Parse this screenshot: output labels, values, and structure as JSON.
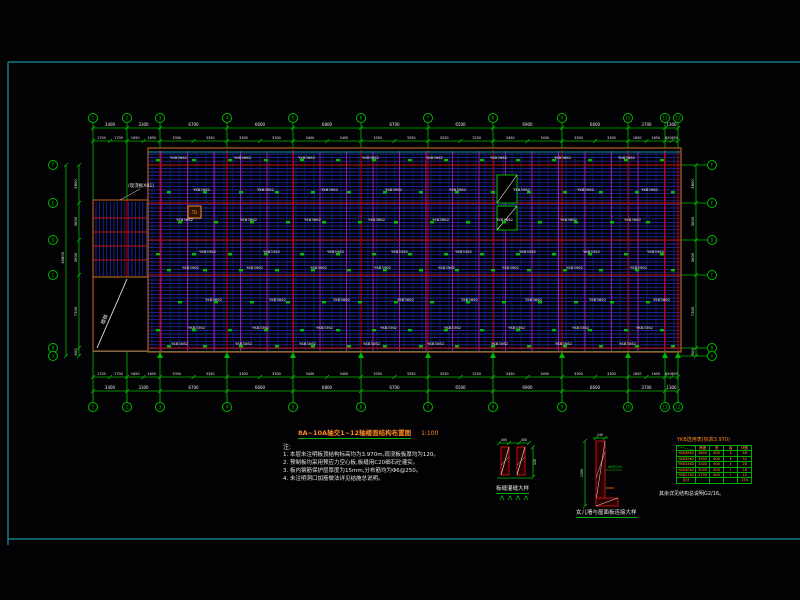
{
  "drawing": {
    "title": "8A~10A轴交1~12轴楼面结构布置图",
    "scale": "1:100",
    "notes_label": "注:",
    "notes": [
      "1. 本层未注明板顶结构标高均为3.970m,现浇板板厚均为120。",
      "2. 预制板均采用预应力空心板,板缝用C20细石砼灌实。",
      "3. 板内钢筋保护层厚度为15mm,分布筋均为Φ6@250。",
      "4. 未注明洞口加筋做法详见结施总说明。"
    ],
    "cast_label": "(现浇板XB1)",
    "stair_label": "楼梯",
    "opening_label": "TD"
  },
  "axes": {
    "top": [
      "1",
      "2",
      "3",
      "4",
      "5",
      "6",
      "7",
      "8",
      "9",
      "10",
      "11",
      "12"
    ],
    "left": [
      "F",
      "E",
      "D",
      "C",
      "B",
      "A"
    ],
    "right": [
      "F",
      "E",
      "D",
      "C",
      "B",
      "A"
    ]
  },
  "dimensions": {
    "top_spans": [
      "3400",
      "3300",
      "6700",
      "6600",
      "6800",
      "6700",
      "6500",
      "6900",
      "6600",
      "3700",
      "1300"
    ],
    "left_spans": [
      "3800",
      "3600",
      "3600",
      "7300",
      "800"
    ],
    "left_total": "18800"
  },
  "plank_rows": [
    "YKB3662",
    "YKB3962",
    "YKB3662",
    "YKB3362",
    "YKB3962",
    "YKB3662",
    "YKB3362",
    "YKB3062"
  ],
  "details": {
    "left": {
      "label": "板缝灌缝大样",
      "dim_a": "400",
      "dim_b": "400",
      "dim_h": "120"
    },
    "right": {
      "label": "女儿墙与屋面板连接大样",
      "dim_h": "1200",
      "dim_w": "240",
      "rebar": "Φ8@200"
    }
  },
  "table": {
    "title": "YKB选用表(标高3.970)",
    "headers": [
      "板号",
      "跨度",
      "宽",
      "级",
      "块数"
    ],
    "rows": [
      [
        "YKB3662",
        "3600",
        "600",
        "Ⅱ",
        "46"
      ],
      [
        "YKB3962",
        "3900",
        "600",
        "Ⅱ",
        "52"
      ],
      [
        "YKB3362",
        "3300",
        "600",
        "Ⅱ",
        "28"
      ],
      [
        "YKB3062",
        "3000",
        "600",
        "Ⅰ",
        "16"
      ],
      [
        "YKB2762",
        "2700",
        "600",
        "Ⅰ",
        "12"
      ],
      [
        "合计",
        "",
        "",
        "",
        "154"
      ]
    ],
    "footnote": "其余详见结构总说明G2/16。"
  },
  "colors": {
    "cyan": "#17929b",
    "green": "#00bb00",
    "red": "#c21010",
    "dark_red": "#a80000",
    "blue": "#2130c4",
    "dark_blue": "#1b2a99",
    "magenta": "#b517b5",
    "orange": "#ff8822",
    "brown": "#a8571c",
    "white": "#e8e8e8"
  }
}
